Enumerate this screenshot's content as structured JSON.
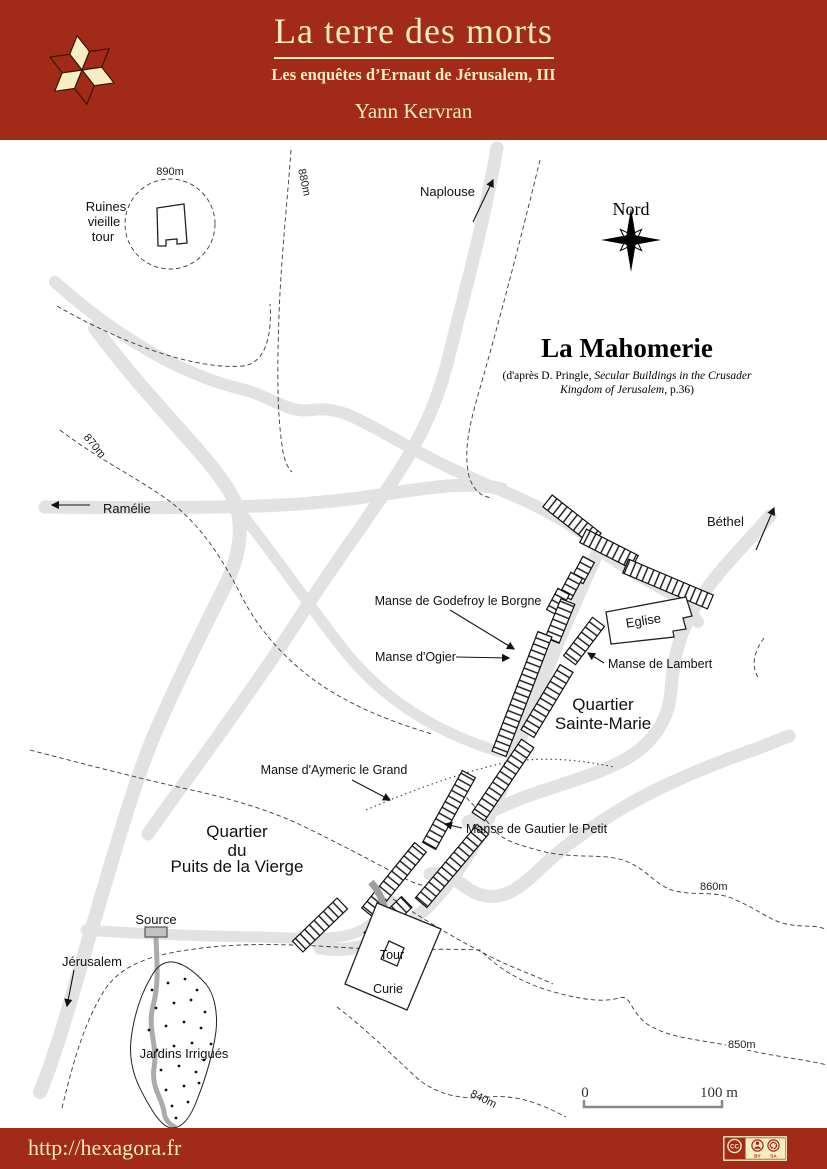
{
  "colors": {
    "header_bg": "#A22A18",
    "cream": "#F6EDC2",
    "road_gray": "#E2E2E2",
    "stream_gray": "#ABABAB",
    "ink": "#111111"
  },
  "header": {
    "title": "La terre des morts",
    "subtitle": "Les enquêtes d’Ernaut de Jérusalem, III",
    "author": "Yann Kervran"
  },
  "map": {
    "title": "La Mahomerie",
    "attribution": {
      "pre": "(d'après D. Pringle, ",
      "italic1": "Secular Buildings in the Crusader",
      "italic2": "Kingdom of Jerusalem",
      "post": ", p.36)"
    },
    "compass": {
      "label": "Nord"
    },
    "scale": {
      "start": "0",
      "end": "100 m"
    },
    "contours": {
      "c890": "890m",
      "c880": "880m",
      "c870": "870m",
      "c860": "860m",
      "c850": "850m",
      "c840": "840m"
    },
    "places": {
      "ruines": [
        "Ruines",
        "vieille",
        "tour"
      ],
      "naplouse": "Naplouse",
      "ramelie": "Ramélie",
      "bethel": "Béthel",
      "jerusalem": "Jérusalem",
      "source": "Source",
      "jardins": "Jardins Irrigués",
      "curie": "Curie",
      "tour": "Tour",
      "eglise": "Eglise"
    },
    "manses": {
      "godefroy": "Manse de Godefroy le Borgne",
      "ogier": "Manse d'Ogier",
      "lambert": "Manse de Lambert",
      "aymeric": "Manse d'Aymeric le Grand",
      "gautier": "Manse de Gautier le Petit"
    },
    "quartiers": {
      "sainte_marie": [
        "Quartier",
        "Sainte-Marie"
      ],
      "puits": [
        "Quartier",
        "du",
        "Puits de la Vierge"
      ]
    }
  },
  "footer": {
    "url": "http://hexagora.fr",
    "license": {
      "cc": "CC",
      "by": "BY",
      "sa": "SA"
    }
  }
}
